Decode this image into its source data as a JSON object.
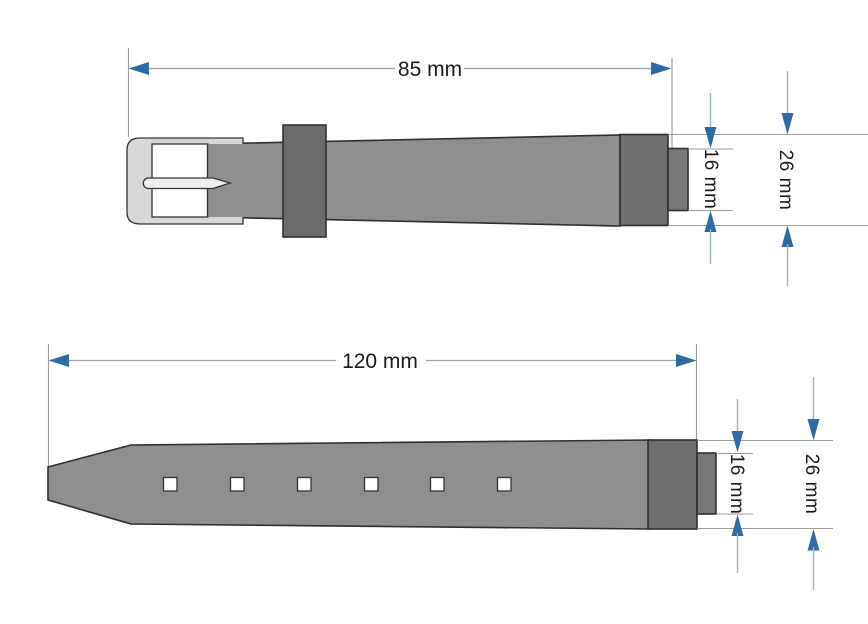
{
  "diagram": {
    "type": "technical-drawing",
    "subject": "Watch strap replacement band dimension drawing",
    "top_strap": {
      "part": "buckle-side strap",
      "length_label": "85 mm",
      "end_width_label": "16 mm",
      "full_width_label": "26 mm"
    },
    "bottom_strap": {
      "part": "tail strap with holes",
      "length_label": "120 mm",
      "end_width_label": "16 mm",
      "full_width_label": "26 mm",
      "hole_count": 6
    },
    "colors": {
      "strap": "#8f8f8f",
      "end_cap": "#6f6f6f",
      "keeper": "#6c6c6c",
      "nub": "#787878",
      "buckle_frame": "#d5d7d9",
      "prong": "#eceeef",
      "hole": "#ffffff",
      "arrow": "#2e6ba3",
      "arrow_shaft": "#9db3c2",
      "dim_line": "#9aa6ad",
      "ref_line": "#9b9b9b",
      "text": "#1b1b1b",
      "background": "#ffffff"
    }
  }
}
